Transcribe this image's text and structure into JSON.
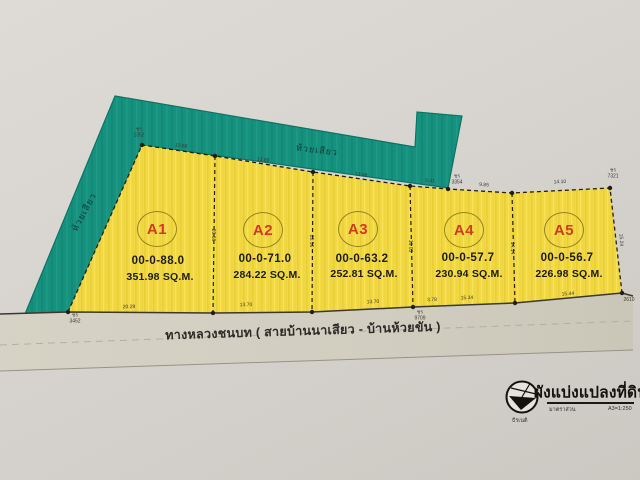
{
  "document": {
    "type_note": "scanned land subdivision plan",
    "title_block": {
      "title": "ผังแบ่งแปลงที่ดิน",
      "scale_label": "มาตราส่วน",
      "scale_value": "A3=1:250",
      "logo_caption": "ธีรเนติ"
    }
  },
  "stream": {
    "name_top": "ห้วยเสียว",
    "name_left": "ห้วยเสียว"
  },
  "road": {
    "name": "ทางหลวงชนบท ( สายบ้านนาเสียว - บ้านห้วยขัน )"
  },
  "plots": [
    {
      "id": "A1",
      "rai": "00-0-88.0",
      "area": "351.98 SQ.M."
    },
    {
      "id": "A2",
      "rai": "00-0-71.0",
      "area": "284.22 SQ.M."
    },
    {
      "id": "A3",
      "rai": "00-0-63.2",
      "area": "252.81 SQ.M."
    },
    {
      "id": "A4",
      "rai": "00-0-57.7",
      "area": "230.94 SQ.M."
    },
    {
      "id": "A5",
      "rai": "00-0-56.7",
      "area": "226.98 SQ.M."
    }
  ],
  "dims": [
    "ชร\n1352",
    "13.88",
    "13.88",
    "13.88",
    "5.41",
    "ชร\n3354",
    "9.85",
    "14.10",
    "ชร\n7321",
    "ชร\n3452",
    "20.29",
    "13.70",
    "13.70",
    "3.78",
    "ชร\n9709",
    "15.34",
    "15.44",
    "2610",
    "20.66",
    "20.56",
    "16.05",
    "14.14",
    "15.24"
  ],
  "colors": {
    "stream_teal": "#169180",
    "parcel_yellow": "#f2d944",
    "plot_label_red": "#d03a23",
    "road_gray": "#d3cfc2",
    "paper": "#d8d5d0"
  }
}
